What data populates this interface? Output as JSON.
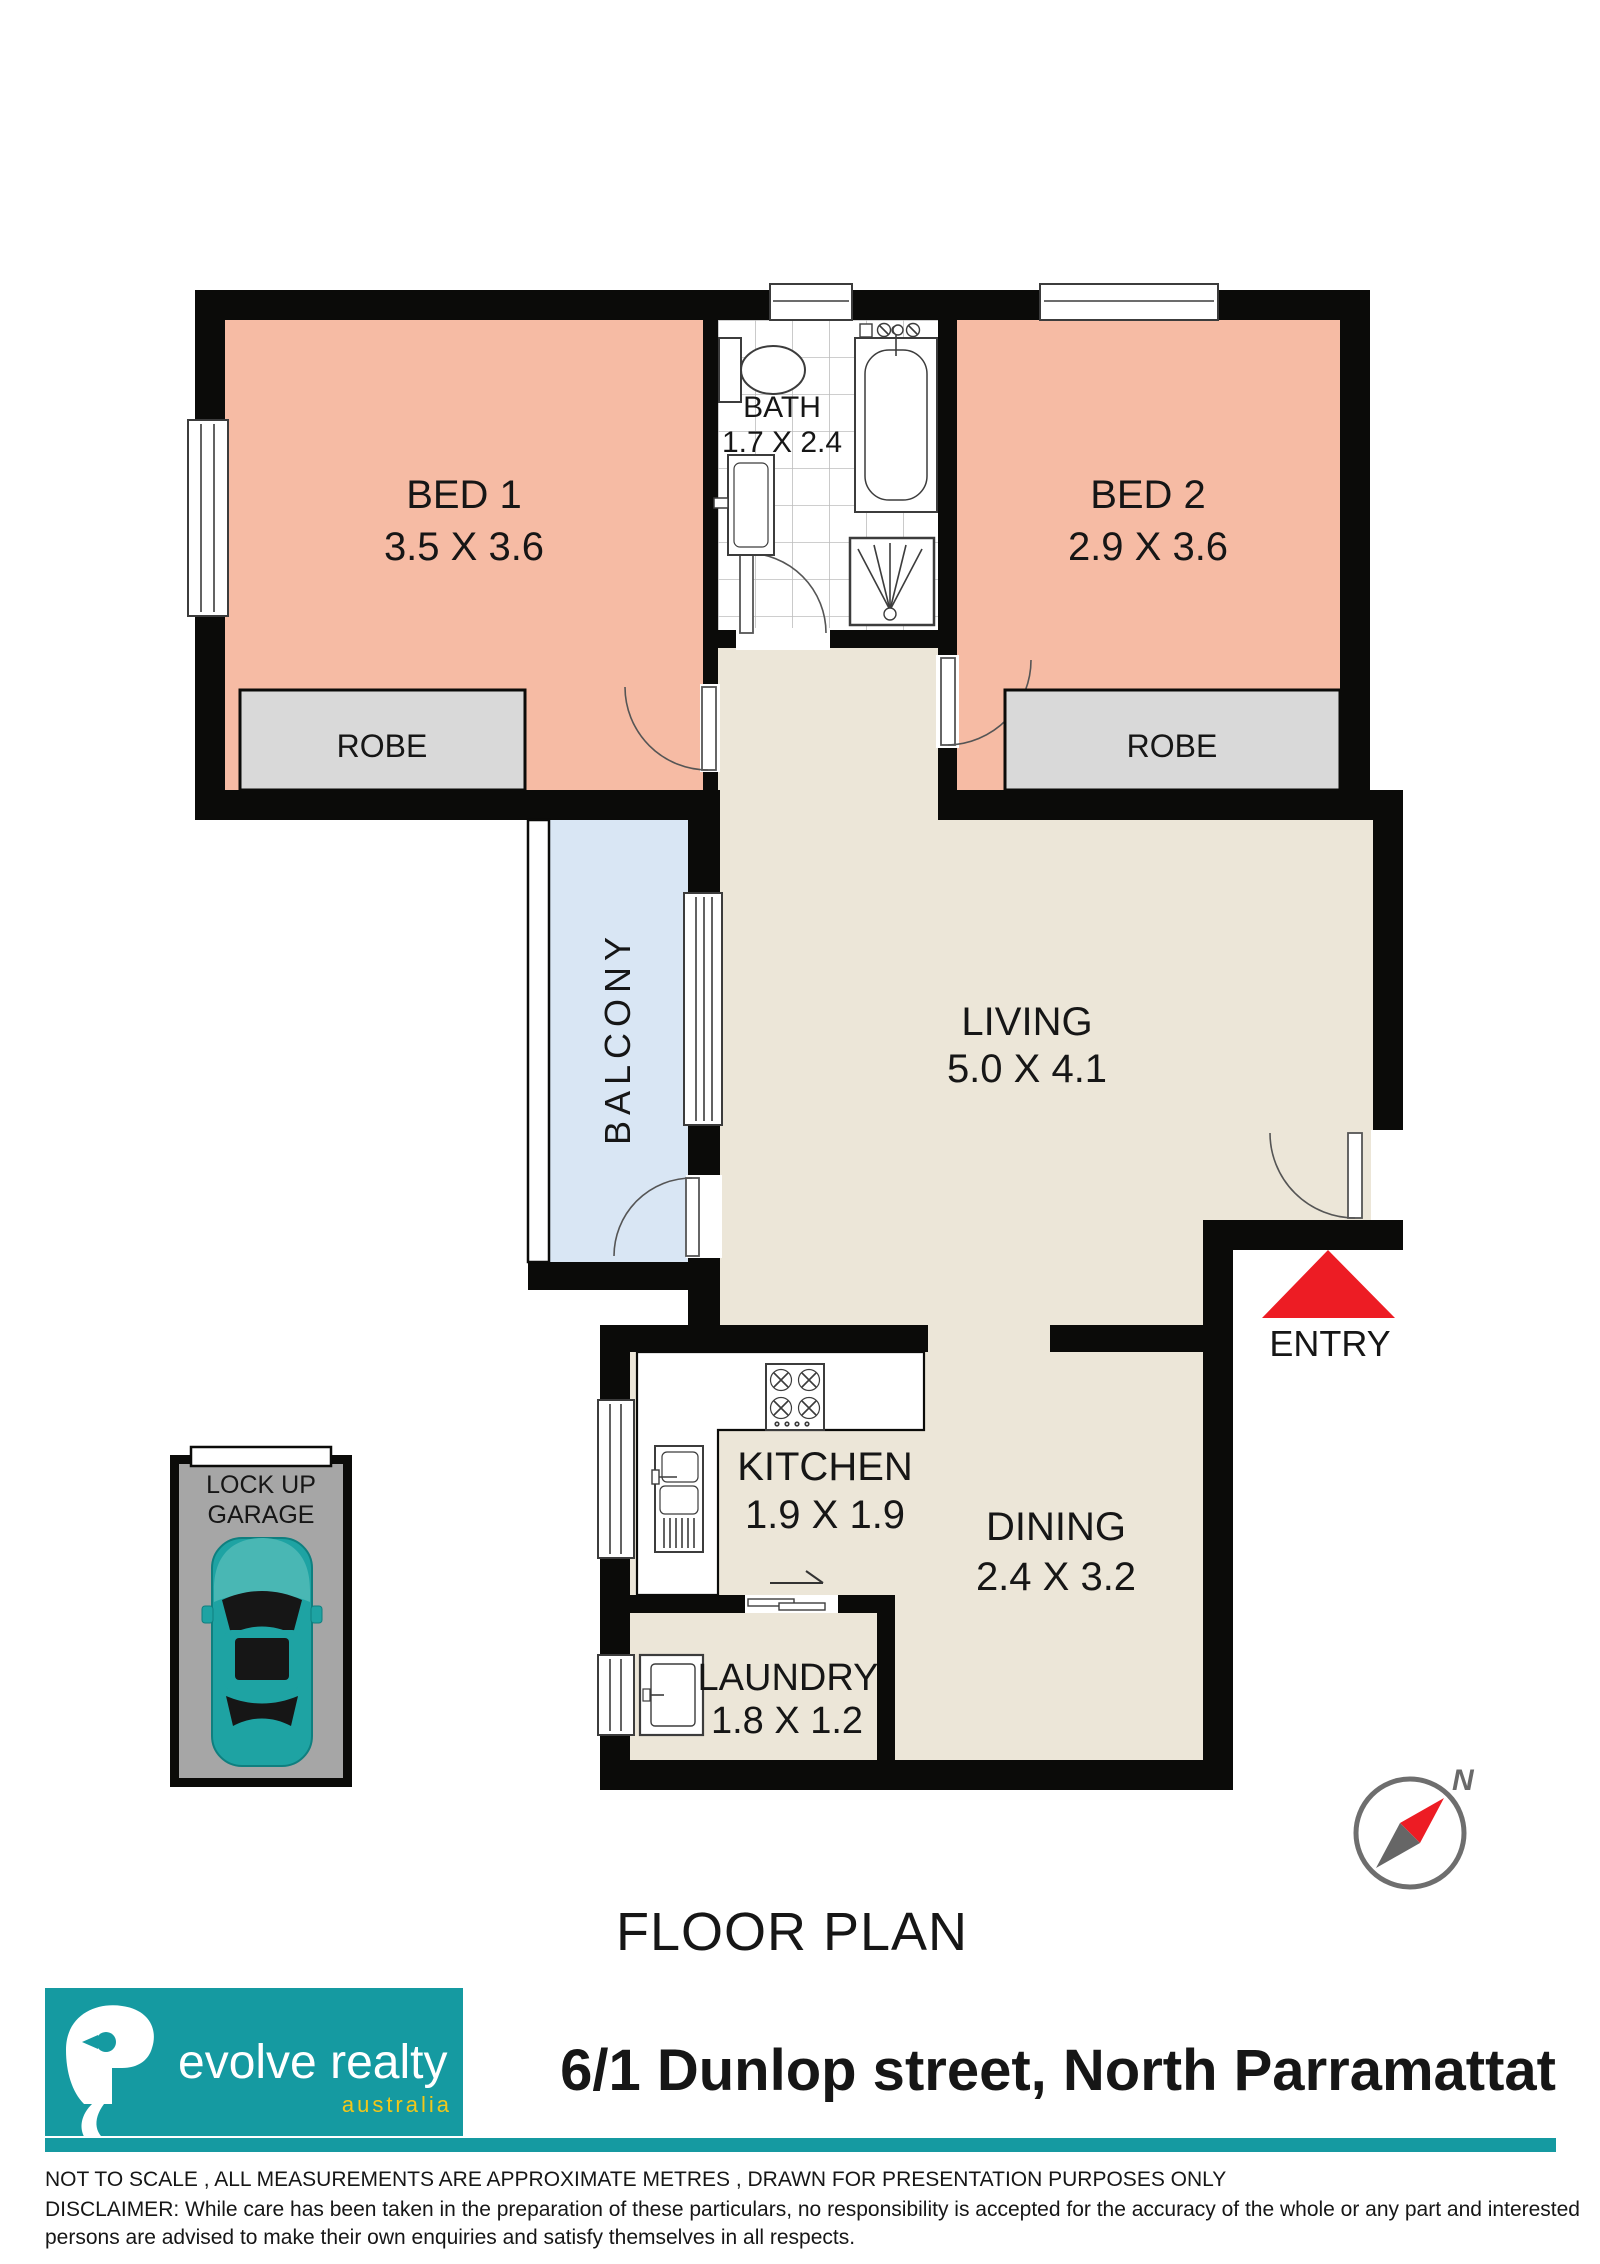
{
  "page": {
    "title": "FLOOR PLAN"
  },
  "plan": {
    "rooms": {
      "bed1": {
        "label": "BED 1",
        "dims": "3.5 X 3.6"
      },
      "bed2": {
        "label": "BED 2",
        "dims": "2.9 X 3.6"
      },
      "bath": {
        "label": "BATH",
        "dims": "1.7 X 2.4"
      },
      "living": {
        "label": "LIVING",
        "dims": "5.0 X 4.1"
      },
      "kitchen": {
        "label": "KITCHEN",
        "dims": "1.9 X 1.9"
      },
      "dining": {
        "label": "DINING",
        "dims": "2.4 X 3.2"
      },
      "laundry": {
        "label": "LAUNDRY",
        "dims": "1.8 X 1.2"
      },
      "balcony": {
        "label": "BALCONY"
      },
      "robe1": {
        "label": "ROBE"
      },
      "robe2": {
        "label": "ROBE"
      },
      "garage": {
        "label_line1": "LOCK UP",
        "label_line2": "GARAGE"
      }
    },
    "entry_label": "ENTRY",
    "compass_label": "N"
  },
  "branding": {
    "agency": "evolve realty",
    "country": "australia",
    "address": "6/1 Dunlop street, North Parramattat",
    "accent_teal": "#159aa1",
    "accent_yellow": "#f3c719"
  },
  "colors": {
    "bedroom_fill": "#f6bba4",
    "living_fill": "#ece6d8",
    "balcony_fill": "#d9e6f4",
    "robe_fill": "#d9d9d9",
    "garage_fill": "#a6a6a6",
    "wall": "#0b0b09",
    "entry_arrow": "#ed1c24",
    "car": "#1ea3a3"
  },
  "footer": {
    "line1": "NOT TO SCALE , ALL MEASUREMENTS ARE APPROXIMATE METRES , DRAWN FOR PRESENTATION PURPOSES ONLY",
    "line2": "DISCLAIMER:  While care has been taken in the preparation of these particulars, no responsibility is accepted for the accuracy of the whole or any part and interested",
    "line3": "persons are advised to make their own enquiries and satisfy  themselves in all respects."
  }
}
